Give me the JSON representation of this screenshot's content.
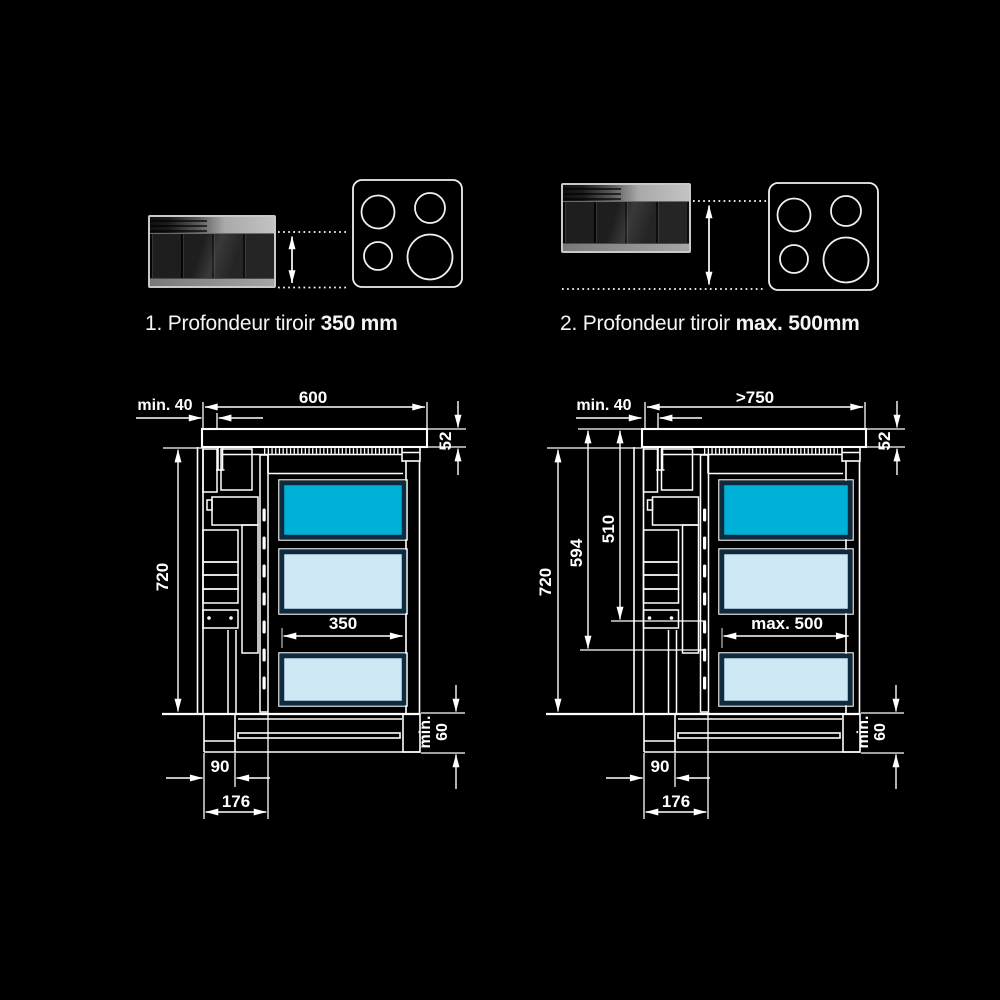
{
  "background": "#000000",
  "colors": {
    "line": "#ffffff",
    "drawer_highlight": "#00b1d7",
    "drawer_light": "#cfe8f6",
    "drawer_border": "#0d2a3e"
  },
  "icons": {
    "hob": "induction-hob-4-zones-top-view-icon",
    "depth_arrow": "double-vertical-arrow-icon"
  },
  "figures": {
    "left": {
      "caption": {
        "index_text": "1. Profondeur tiroir ",
        "value_text": "350 mm"
      },
      "dimensions": {
        "offset_top": "min. 40",
        "width": "600",
        "worktop_thickness": "52",
        "cabinet_height": "720",
        "drawer_depth": "350",
        "plinth_height": [
          "min.",
          "60"
        ],
        "front_bottom": "90",
        "front_total": "176"
      }
    },
    "right": {
      "caption": {
        "index_text": "2. Profondeur tiroir ",
        "value_text": "max. 500mm"
      },
      "dimensions": {
        "offset_top": "min. 40",
        "width": ">750",
        "worktop_thickness": "52",
        "cabinet_height": "720",
        "clearance_total": "594",
        "clearance_inner": "510",
        "drawer_depth": "max. 500",
        "plinth_height": [
          "min.",
          "60"
        ],
        "front_bottom": "90",
        "front_total": "176"
      }
    }
  }
}
